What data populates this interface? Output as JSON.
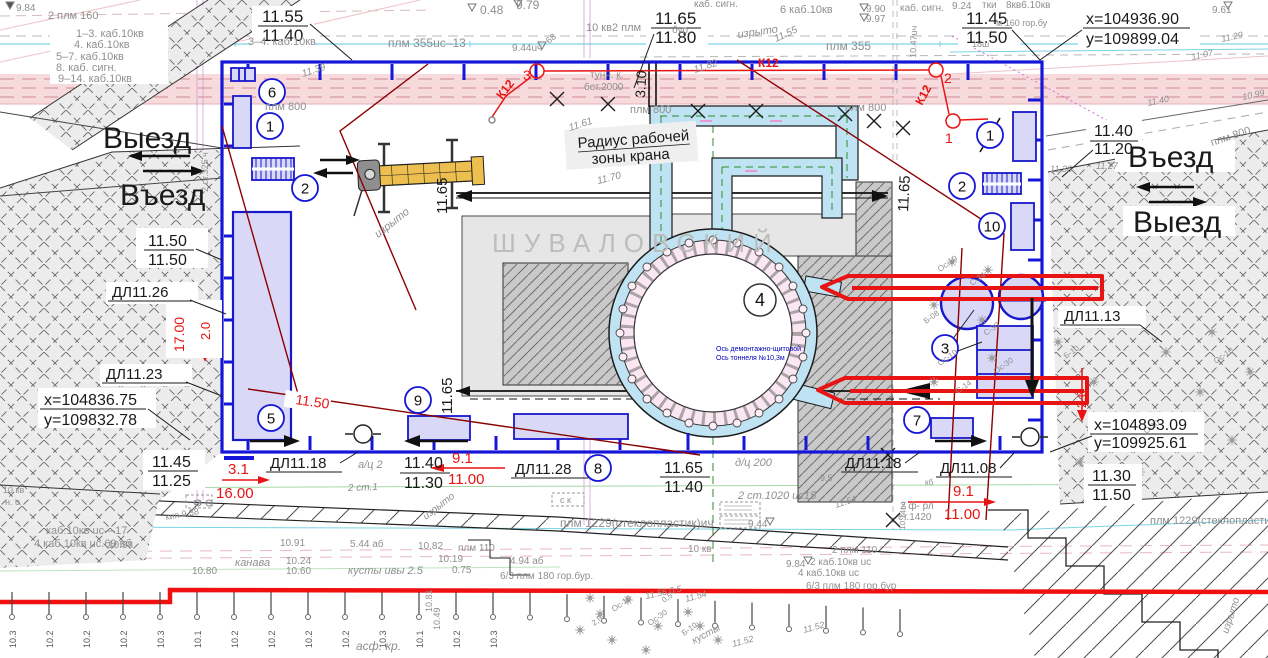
{
  "watermark_text": "ШУВАЛОВСКИЙ",
  "roads": {
    "exit_left": "Выезд",
    "enter_left": "Въезд",
    "enter_right": "Въезд",
    "exit_right": "Выезд"
  },
  "crane": {
    "line1": "Радиус рабочей",
    "line2": "зоны крана"
  },
  "site_coords": {
    "tr_x": "x=104936.90",
    "tr_y": "y=109899.04",
    "bl_x": "x=104836.75",
    "bl_y": "y=109832.78",
    "br_x": "x=104893.09",
    "br_y": "y=109925.61"
  },
  "colors": {
    "k": "#1a1a1a",
    "g": "#8f8f8f",
    "r": "#e81313",
    "dr": "#8b0000",
    "b": "#1616d8",
    "db": "#0000bb",
    "w": "#bdbdbd",
    "green": "#2a8f2a"
  },
  "labels": [
    {
      "t": "11.55",
      "x": 262,
      "y": 22,
      "s": 17,
      "c": "k"
    },
    {
      "t": "11.40",
      "x": 262,
      "y": 41,
      "s": 17,
      "c": "k"
    },
    {
      "t": "11.65",
      "x": 655,
      "y": 24,
      "s": 17,
      "c": "k"
    },
    {
      "t": "11.80",
      "x": 655,
      "y": 43,
      "s": 17,
      "c": "k"
    },
    {
      "t": "11.45",
      "x": 966,
      "y": 24,
      "s": 17,
      "c": "k"
    },
    {
      "t": "11.50",
      "x": 966,
      "y": 43,
      "s": 17,
      "c": "k"
    },
    {
      "t": "11.40",
      "x": 1094,
      "y": 136,
      "s": 16,
      "c": "k"
    },
    {
      "t": "11.20",
      "x": 1094,
      "y": 154,
      "s": 16,
      "c": "k"
    },
    {
      "t": "11.50",
      "x": 148,
      "y": 246,
      "s": 16,
      "c": "k"
    },
    {
      "t": "11.50",
      "x": 148,
      "y": 265,
      "s": 16,
      "c": "k"
    },
    {
      "t": "ДЛ11.26",
      "x": 112,
      "y": 297,
      "s": 15,
      "c": "k"
    },
    {
      "t": "ДЛ11.23",
      "x": 106,
      "y": 379,
      "s": 15,
      "c": "k"
    },
    {
      "t": "11.45",
      "x": 152,
      "y": 467,
      "s": 16,
      "c": "k"
    },
    {
      "t": "11.25",
      "x": 152,
      "y": 486,
      "s": 16,
      "c": "k"
    },
    {
      "t": "ДЛ11.18",
      "x": 270,
      "y": 468,
      "s": 15,
      "c": "k"
    },
    {
      "t": "11.40",
      "x": 404,
      "y": 468,
      "s": 16,
      "c": "k"
    },
    {
      "t": "11.30",
      "x": 404,
      "y": 488,
      "s": 16,
      "c": "k"
    },
    {
      "t": "ДЛ11.28",
      "x": 515,
      "y": 474,
      "s": 15,
      "c": "k"
    },
    {
      "t": "11.65",
      "x": 664,
      "y": 473,
      "s": 16,
      "c": "k"
    },
    {
      "t": "11.40",
      "x": 664,
      "y": 492,
      "s": 16,
      "c": "k"
    },
    {
      "t": "ДЛ11.18",
      "x": 845,
      "y": 468,
      "s": 15,
      "c": "k"
    },
    {
      "t": "ДЛ11.08",
      "x": 940,
      "y": 473,
      "s": 15,
      "c": "k"
    },
    {
      "t": "ДЛ11.13",
      "x": 1064,
      "y": 321,
      "s": 15,
      "c": "k"
    },
    {
      "t": "11.30",
      "x": 1092,
      "y": 481,
      "s": 16,
      "c": "k"
    },
    {
      "t": "11.50",
      "x": 1092,
      "y": 500,
      "s": 16,
      "c": "k"
    },
    {
      "t": "11.65",
      "x": 447,
      "y": 214,
      "s": 15,
      "c": "k",
      "r": -90
    },
    {
      "t": "11.65",
      "x": 452,
      "y": 414,
      "s": 15,
      "c": "k",
      "r": -90
    },
    {
      "t": "11.65",
      "x": 908,
      "y": 212,
      "s": 15,
      "c": "k",
      "r": -87
    },
    {
      "t": "3.10",
      "x": 645,
      "y": 98,
      "s": 14,
      "c": "k",
      "r": -87
    },
    {
      "t": "Ось демонтажно-щитовой",
      "x": 716,
      "y": 351,
      "s": 7,
      "c": "db"
    },
    {
      "t": "Ось тоннеля №10,3м",
      "x": 716,
      "y": 360,
      "s": 7,
      "c": "db"
    },
    {
      "t": "3.1",
      "x": 228,
      "y": 474,
      "s": 15,
      "c": "r"
    },
    {
      "t": "16.00",
      "x": 216,
      "y": 498,
      "s": 15,
      "c": "r"
    },
    {
      "t": "9.1",
      "x": 452,
      "y": 463,
      "s": 15,
      "c": "r"
    },
    {
      "t": "11.00",
      "x": 448,
      "y": 484,
      "s": 15,
      "c": "r"
    },
    {
      "t": "9.1",
      "x": 953,
      "y": 496,
      "s": 15,
      "c": "r"
    },
    {
      "t": "11.00",
      "x": 944,
      "y": 519,
      "s": 15,
      "c": "r"
    },
    {
      "t": "17.00",
      "x": 184,
      "y": 352,
      "s": 14,
      "c": "r",
      "r": -90
    },
    {
      "t": "2.0",
      "x": 210,
      "y": 340,
      "s": 13,
      "c": "r",
      "r": -90
    },
    {
      "t": "2.0",
      "x": 1086,
      "y": 408,
      "s": 13,
      "c": "r",
      "r": -90
    },
    {
      "t": "11.50",
      "x": 295,
      "y": 404,
      "s": 14,
      "c": "r",
      "r": 8
    },
    {
      "t": "К12",
      "x": 502,
      "y": 100,
      "s": 12,
      "c": "r",
      "r": -52,
      "b": 1
    },
    {
      "t": "К12",
      "x": 758,
      "y": 67,
      "s": 12,
      "c": "r",
      "b": 1
    },
    {
      "t": "К12",
      "x": 922,
      "y": 106,
      "s": 12,
      "c": "r",
      "r": -62,
      "b": 1
    },
    {
      "t": "3",
      "x": 523,
      "y": 80,
      "s": 14,
      "c": "r"
    },
    {
      "t": "2",
      "x": 944,
      "y": 83,
      "s": 14,
      "c": "r"
    },
    {
      "t": "1",
      "x": 945,
      "y": 143,
      "s": 14,
      "c": "r"
    },
    {
      "t": "9.84",
      "x": 16,
      "y": 11,
      "s": 10
    },
    {
      "t": "2 плм 160",
      "x": 48,
      "y": 19,
      "s": 11
    },
    {
      "t": "1–3. каб.10кв",
      "x": 76,
      "y": 37,
      "s": 11
    },
    {
      "t": "4. каб.10кв",
      "x": 74,
      "y": 48,
      "s": 11
    },
    {
      "t": "5–7. каб.10кв",
      "x": 56,
      "y": 60,
      "s": 11
    },
    {
      "t": "8. каб. сигн.",
      "x": 56,
      "y": 71,
      "s": 11
    },
    {
      "t": "9–14. каб.10кв",
      "x": 58,
      "y": 82,
      "s": 11
    },
    {
      "t": "3–4. каб.10кв",
      "x": 248,
      "y": 45,
      "s": 11
    },
    {
      "t": "плм 355uc–13",
      "x": 388,
      "y": 47,
      "s": 12
    },
    {
      "t": "0.48",
      "x": 480,
      "y": 14,
      "s": 12
    },
    {
      "t": "9.79",
      "x": 516,
      "y": 9,
      "s": 12
    },
    {
      "t": "9.44uч",
      "x": 512,
      "y": 51,
      "s": 10
    },
    {
      "t": "68",
      "x": 549,
      "y": 44,
      "s": 9,
      "r": -40
    },
    {
      "t": "10 кв2 плм",
      "x": 586,
      "y": 31,
      "s": 11
    },
    {
      "t": "тунн. к.",
      "x": 590,
      "y": 78,
      "s": 10
    },
    {
      "t": "бет.2000",
      "x": 584,
      "y": 90,
      "s": 10
    },
    {
      "t": "плм 800",
      "x": 630,
      "y": 113,
      "s": 11
    },
    {
      "t": "плм 800",
      "x": 845,
      "y": 111,
      "s": 11
    },
    {
      "t": "плм 800",
      "x": 265,
      "y": 110,
      "s": 11
    },
    {
      "t": "каб. сигн.",
      "x": 694,
      "y": 7,
      "s": 10
    },
    {
      "t": "6 каб.10кв",
      "x": 780,
      "y": 13,
      "s": 11
    },
    {
      "t": "9.90",
      "x": 866,
      "y": 12,
      "s": 10
    },
    {
      "t": "9.97",
      "x": 866,
      "y": 22,
      "s": 10
    },
    {
      "t": "каб. сигн.",
      "x": 900,
      "y": 11,
      "s": 10
    },
    {
      "t": "плм 355",
      "x": 826,
      "y": 50,
      "s": 12
    },
    {
      "t": "изрыто",
      "x": 738,
      "y": 38,
      "s": 11,
      "i": 1,
      "r": -8
    },
    {
      "t": "11.55",
      "x": 776,
      "y": 42,
      "s": 10,
      "i": 1,
      "r": -25
    },
    {
      "t": "10.47uч",
      "x": 916,
      "y": 58,
      "s": 9,
      "r": -88
    },
    {
      "t": "бур.",
      "x": 672,
      "y": 33,
      "s": 10
    },
    {
      "t": "9.24",
      "x": 952,
      "y": 9,
      "s": 10
    },
    {
      "t": "тки",
      "x": 982,
      "y": 8,
      "s": 10
    },
    {
      "t": "8кв6.10кв",
      "x": 1006,
      "y": 8,
      "s": 10
    },
    {
      "t": "м 160 гор.бу",
      "x": 996,
      "y": 26,
      "s": 9
    },
    {
      "t": "18ш",
      "x": 972,
      "y": 47,
      "s": 9
    },
    {
      "t": "9.61",
      "x": 1212,
      "y": 13,
      "s": 10
    },
    {
      "t": "11.29",
      "x": 1222,
      "y": 42,
      "s": 9,
      "i": 1,
      "r": -12
    },
    {
      "t": "11.07",
      "x": 1192,
      "y": 60,
      "s": 9,
      "i": 1,
      "r": -12
    },
    {
      "t": "10.99",
      "x": 1243,
      "y": 100,
      "s": 9,
      "i": 1,
      "r": -12
    },
    {
      "t": "11.40",
      "x": 1148,
      "y": 106,
      "s": 9,
      "i": 1,
      "r": -12
    },
    {
      "t": "плм 800",
      "x": 1212,
      "y": 146,
      "s": 11,
      "r": -18
    },
    {
      "t": "11.36",
      "x": 1050,
      "y": 172,
      "s": 9,
      "i": 1
    },
    {
      "t": "11.27",
      "x": 1096,
      "y": 169,
      "s": 9,
      "i": 1
    },
    {
      "t": "11.39",
      "x": 303,
      "y": 77,
      "s": 10,
      "i": 1,
      "r": -18
    },
    {
      "t": "11.61",
      "x": 570,
      "y": 131,
      "s": 10,
      "i": 1,
      "r": -18
    },
    {
      "t": "11.82",
      "x": 695,
      "y": 73,
      "s": 10,
      "i": 1,
      "r": -18
    },
    {
      "t": "11.70",
      "x": 598,
      "y": 184,
      "s": 10,
      "i": 1,
      "r": -14
    },
    {
      "t": "изрыто",
      "x": 378,
      "y": 238,
      "s": 11,
      "i": 1,
      "r": -38
    },
    {
      "t": "2 ст.325 ч",
      "x": 208,
      "y": 192,
      "s": 9,
      "r": -90
    },
    {
      "t": "а/ц 2",
      "x": 358,
      "y": 468,
      "s": 11,
      "i": 1
    },
    {
      "t": "д/ц 200",
      "x": 735,
      "y": 466,
      "s": 11,
      "i": 1
    },
    {
      "t": "2 ст.1",
      "x": 348,
      "y": 491,
      "s": 10,
      "i": 1,
      "r": -2
    },
    {
      "t": "2 ст.1020   uc15",
      "x": 738,
      "y": 499,
      "s": 11,
      "i": 1
    },
    {
      "t": "9.5",
      "x": 820,
      "y": 481,
      "s": 9
    },
    {
      "t": "кб",
      "x": 925,
      "y": 485,
      "s": 8
    },
    {
      "t": "2 ф- рл",
      "x": 900,
      "y": 509,
      "s": 10
    },
    {
      "t": "ст.1420",
      "x": 898,
      "y": 520,
      "s": 10
    },
    {
      "t": "11.64",
      "x": 836,
      "y": 508,
      "s": 9,
      "i": 1,
      "r": -18
    },
    {
      "t": "10.14uч",
      "x": 905,
      "y": 530,
      "s": 8,
      "r": -88
    },
    {
      "t": "изрыто",
      "x": 426,
      "y": 520,
      "s": 10,
      "i": 1,
      "r": -38
    },
    {
      "t": "кип 9.38",
      "x": 166,
      "y": 520,
      "s": 9,
      "r": -10
    },
    {
      "t": "н. о",
      "x": 5,
      "y": 505,
      "s": 9
    },
    {
      "t": "10 кв",
      "x": 3,
      "y": 493,
      "s": 9
    },
    {
      "t": "ск",
      "x": 193,
      "y": 505,
      "s": 9
    },
    {
      "t": "с к",
      "x": 560,
      "y": 503,
      "s": 9
    },
    {
      "t": "каб.10кв  uc—17",
      "x": 46,
      "y": 534,
      "s": 11
    },
    {
      "t": "4 каб.10кв  uc.69  вб",
      "x": 34,
      "y": 547,
      "s": 11
    },
    {
      "t": "10.98",
      "x": 108,
      "y": 548,
      "s": 10
    },
    {
      "t": "10.91",
      "x": 280,
      "y": 546,
      "s": 10
    },
    {
      "t": "5.44 аб",
      "x": 350,
      "y": 547,
      "s": 10
    },
    {
      "t": "10.82",
      "x": 418,
      "y": 549,
      "s": 10
    },
    {
      "t": "плм 110",
      "x": 458,
      "y": 551,
      "s": 10
    },
    {
      "t": "канава",
      "x": 235,
      "y": 566,
      "s": 11,
      "i": 1
    },
    {
      "t": "10.24",
      "x": 286,
      "y": 564,
      "s": 10
    },
    {
      "t": "10.60",
      "x": 286,
      "y": 574,
      "s": 10
    },
    {
      "t": "10.80",
      "x": 192,
      "y": 574,
      "s": 10
    },
    {
      "t": "кусты ивы 2.5",
      "x": 348,
      "y": 574,
      "s": 11,
      "i": 1
    },
    {
      "t": "10.19",
      "x": 438,
      "y": 562,
      "s": 10
    },
    {
      "t": "0.75",
      "x": 452,
      "y": 573,
      "s": 10
    },
    {
      "t": "4.94 аб",
      "x": 510,
      "y": 564,
      "s": 10
    },
    {
      "t": "6/3 плм 180  гор.бур.",
      "x": 500,
      "y": 579,
      "s": 10
    },
    {
      "t": "плм 1229(стеклопластик)ич",
      "x": 560,
      "y": 527,
      "s": 12
    },
    {
      "t": "9.44",
      "x": 748,
      "y": 527,
      "s": 10
    },
    {
      "t": "10 кв",
      "x": 688,
      "y": 552,
      "s": 10
    },
    {
      "t": "2 плм 110",
      "x": 832,
      "y": 553,
      "s": 10
    },
    {
      "t": "9.84",
      "x": 786,
      "y": 567,
      "s": 10
    },
    {
      "t": "2 каб.10кв  uc",
      "x": 810,
      "y": 565,
      "s": 10
    },
    {
      "t": "4 каб.10кв  uc",
      "x": 798,
      "y": 576,
      "s": 10
    },
    {
      "t": "6/3 плм 180  гор.бур",
      "x": 806,
      "y": 589,
      "s": 10
    },
    {
      "t": "асф. кр.",
      "x": 356,
      "y": 650,
      "s": 12,
      "i": 1
    },
    {
      "t": "10.81",
      "x": 432,
      "y": 612,
      "s": 9,
      "r": -90
    },
    {
      "t": "10.49",
      "x": 440,
      "y": 630,
      "s": 9,
      "r": -90
    },
    {
      "t": "11.56 0,5",
      "x": 646,
      "y": 599,
      "s": 9,
      "i": 1,
      "r": -12
    },
    {
      "t": "11.54",
      "x": 686,
      "y": 602,
      "s": 9,
      "i": 1,
      "r": -15
    },
    {
      "t": "11.52",
      "x": 733,
      "y": 647,
      "s": 9,
      "i": 1,
      "r": -15
    },
    {
      "t": "11.52",
      "x": 804,
      "y": 633,
      "s": 9,
      "i": 1,
      "r": -15
    },
    {
      "t": "кусты",
      "x": 694,
      "y": 644,
      "s": 10,
      "i": 1,
      "r": -28
    },
    {
      "t": "изрыто",
      "x": 1228,
      "y": 634,
      "s": 10,
      "i": 1,
      "r": -72
    },
    {
      "t": "плм 1229(стеклопластик",
      "x": 1150,
      "y": 524,
      "s": 11
    },
    {
      "t": "Ос-10",
      "x": 940,
      "y": 272,
      "s": 8,
      "r": -35
    },
    {
      "t": "С-24",
      "x": 972,
      "y": 286,
      "s": 8,
      "r": -35
    },
    {
      "t": "Б-08",
      "x": 926,
      "y": 324,
      "s": 8,
      "r": -35
    },
    {
      "t": "С-30",
      "x": 986,
      "y": 336,
      "s": 8,
      "r": -35
    },
    {
      "t": "Ос-10",
      "x": 940,
      "y": 366,
      "s": 8,
      "r": -35
    },
    {
      "t": "С-14",
      "x": 958,
      "y": 394,
      "s": 8,
      "r": -35
    },
    {
      "t": "Ос-30",
      "x": 996,
      "y": 374,
      "s": 8,
      "r": -35
    },
    {
      "t": "Б-10",
      "x": 1066,
      "y": 359,
      "s": 8,
      "r": -35
    },
    {
      "t": "С-30",
      "x": 1146,
      "y": 434,
      "s": 8,
      "r": -35
    },
    {
      "t": "Ос-10",
      "x": 1216,
      "y": 364,
      "s": 8,
      "r": -35
    },
    {
      "t": "Ос-10",
      "x": 614,
      "y": 612,
      "s": 8,
      "r": -35
    },
    {
      "t": "Ос-30",
      "x": 650,
      "y": 626,
      "s": 8,
      "r": -35
    },
    {
      "t": "Б-10",
      "x": 684,
      "y": 636,
      "s": 8,
      "r": -35
    },
    {
      "t": "0,5",
      "x": 664,
      "y": 603,
      "s": 8,
      "r": -35
    },
    {
      "t": "2,0",
      "x": 594,
      "y": 626,
      "s": 8,
      "r": -35
    }
  ],
  "callouts": {
    "blue": [
      {
        "n": "6",
        "x": 272,
        "y": 92
      },
      {
        "n": "1",
        "x": 270,
        "y": 126
      },
      {
        "n": "2",
        "x": 305,
        "y": 188
      },
      {
        "n": "5",
        "x": 271,
        "y": 418
      },
      {
        "n": "9",
        "x": 418,
        "y": 400
      },
      {
        "n": "8",
        "x": 598,
        "y": 468
      },
      {
        "n": "7",
        "x": 917,
        "y": 420
      },
      {
        "n": "3",
        "x": 945,
        "y": 348
      },
      {
        "n": "10",
        "x": 992,
        "y": 226
      },
      {
        "n": "2",
        "x": 962,
        "y": 186
      },
      {
        "n": "1",
        "x": 990,
        "y": 135
      }
    ],
    "black": [
      {
        "n": "4",
        "x": 760,
        "y": 300
      }
    ],
    "red_points": [
      {
        "x": 537,
        "y": 71
      },
      {
        "x": 936,
        "y": 70
      },
      {
        "x": 953,
        "y": 121
      }
    ]
  },
  "posts": {
    "values": [
      "10.3",
      "10.2",
      "10.2",
      "10.2",
      "10.3",
      "10.1",
      "10.2",
      "10.2",
      "10.2",
      "10.2",
      "10.3",
      "10.1",
      "10.2",
      "10.3"
    ],
    "count": 25
  }
}
